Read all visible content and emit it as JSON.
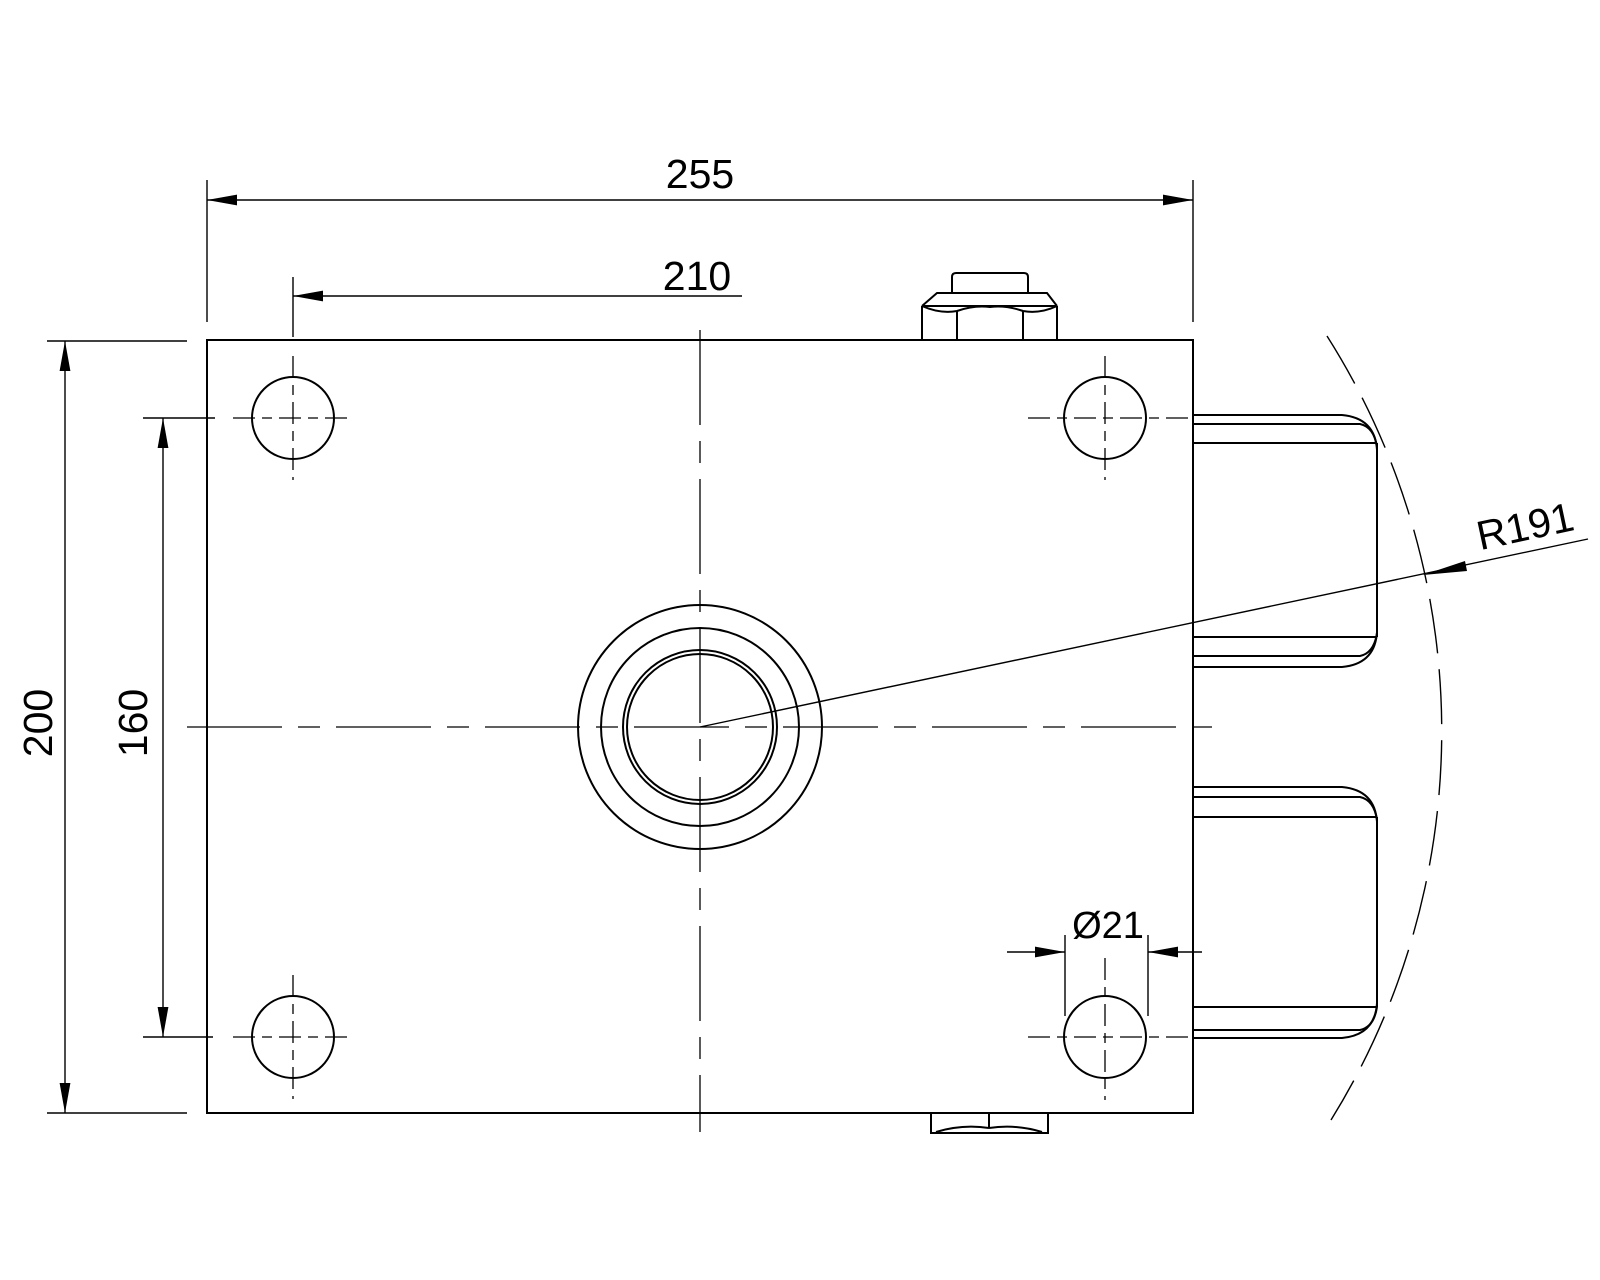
{
  "labels": {
    "total_width": "255",
    "hole_spacing_horizontal": "210",
    "total_height": "200",
    "hole_spacing_vertical": "160",
    "pitch_radius": "R191",
    "hole_diameter": "Ø21"
  }
}
